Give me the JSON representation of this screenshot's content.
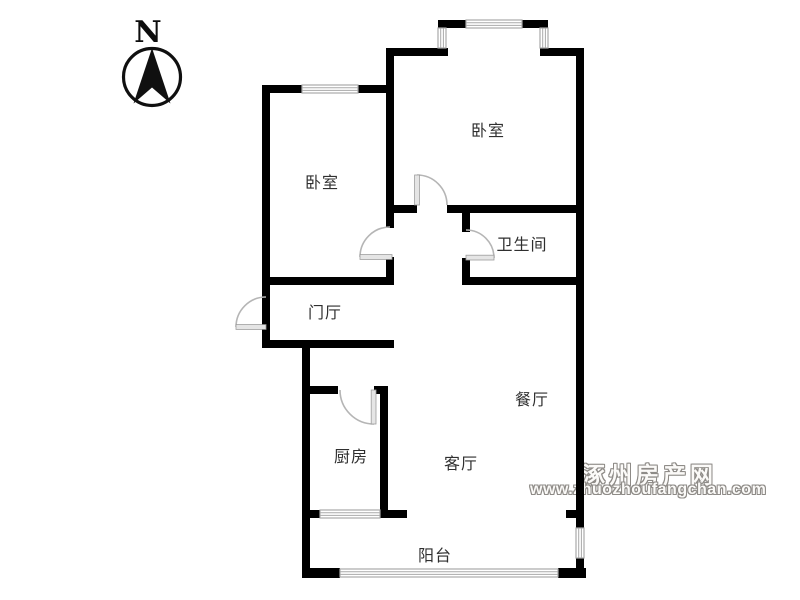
{
  "compass": {
    "label": "N"
  },
  "rooms": {
    "bedroom_top": {
      "label": "卧室"
    },
    "bedroom_left": {
      "label": "卧室"
    },
    "bathroom": {
      "label": "卫生间"
    },
    "entry_hall": {
      "label": "门厅"
    },
    "kitchen": {
      "label": "厨房"
    },
    "dining": {
      "label": "餐厅"
    },
    "living": {
      "label": "客厅"
    },
    "balcony": {
      "label": "阳台"
    }
  },
  "watermark": {
    "site_name": "涿州房产网",
    "site_url": "www.zhuozhoufangchan.com"
  },
  "colors": {
    "background": "#ffffff",
    "wall": "#000000",
    "window_line": "#a9a9a9",
    "door_line": "#b5b5b5",
    "label_text": "#2f2f2f",
    "watermark_outline": "#8e8b87"
  }
}
